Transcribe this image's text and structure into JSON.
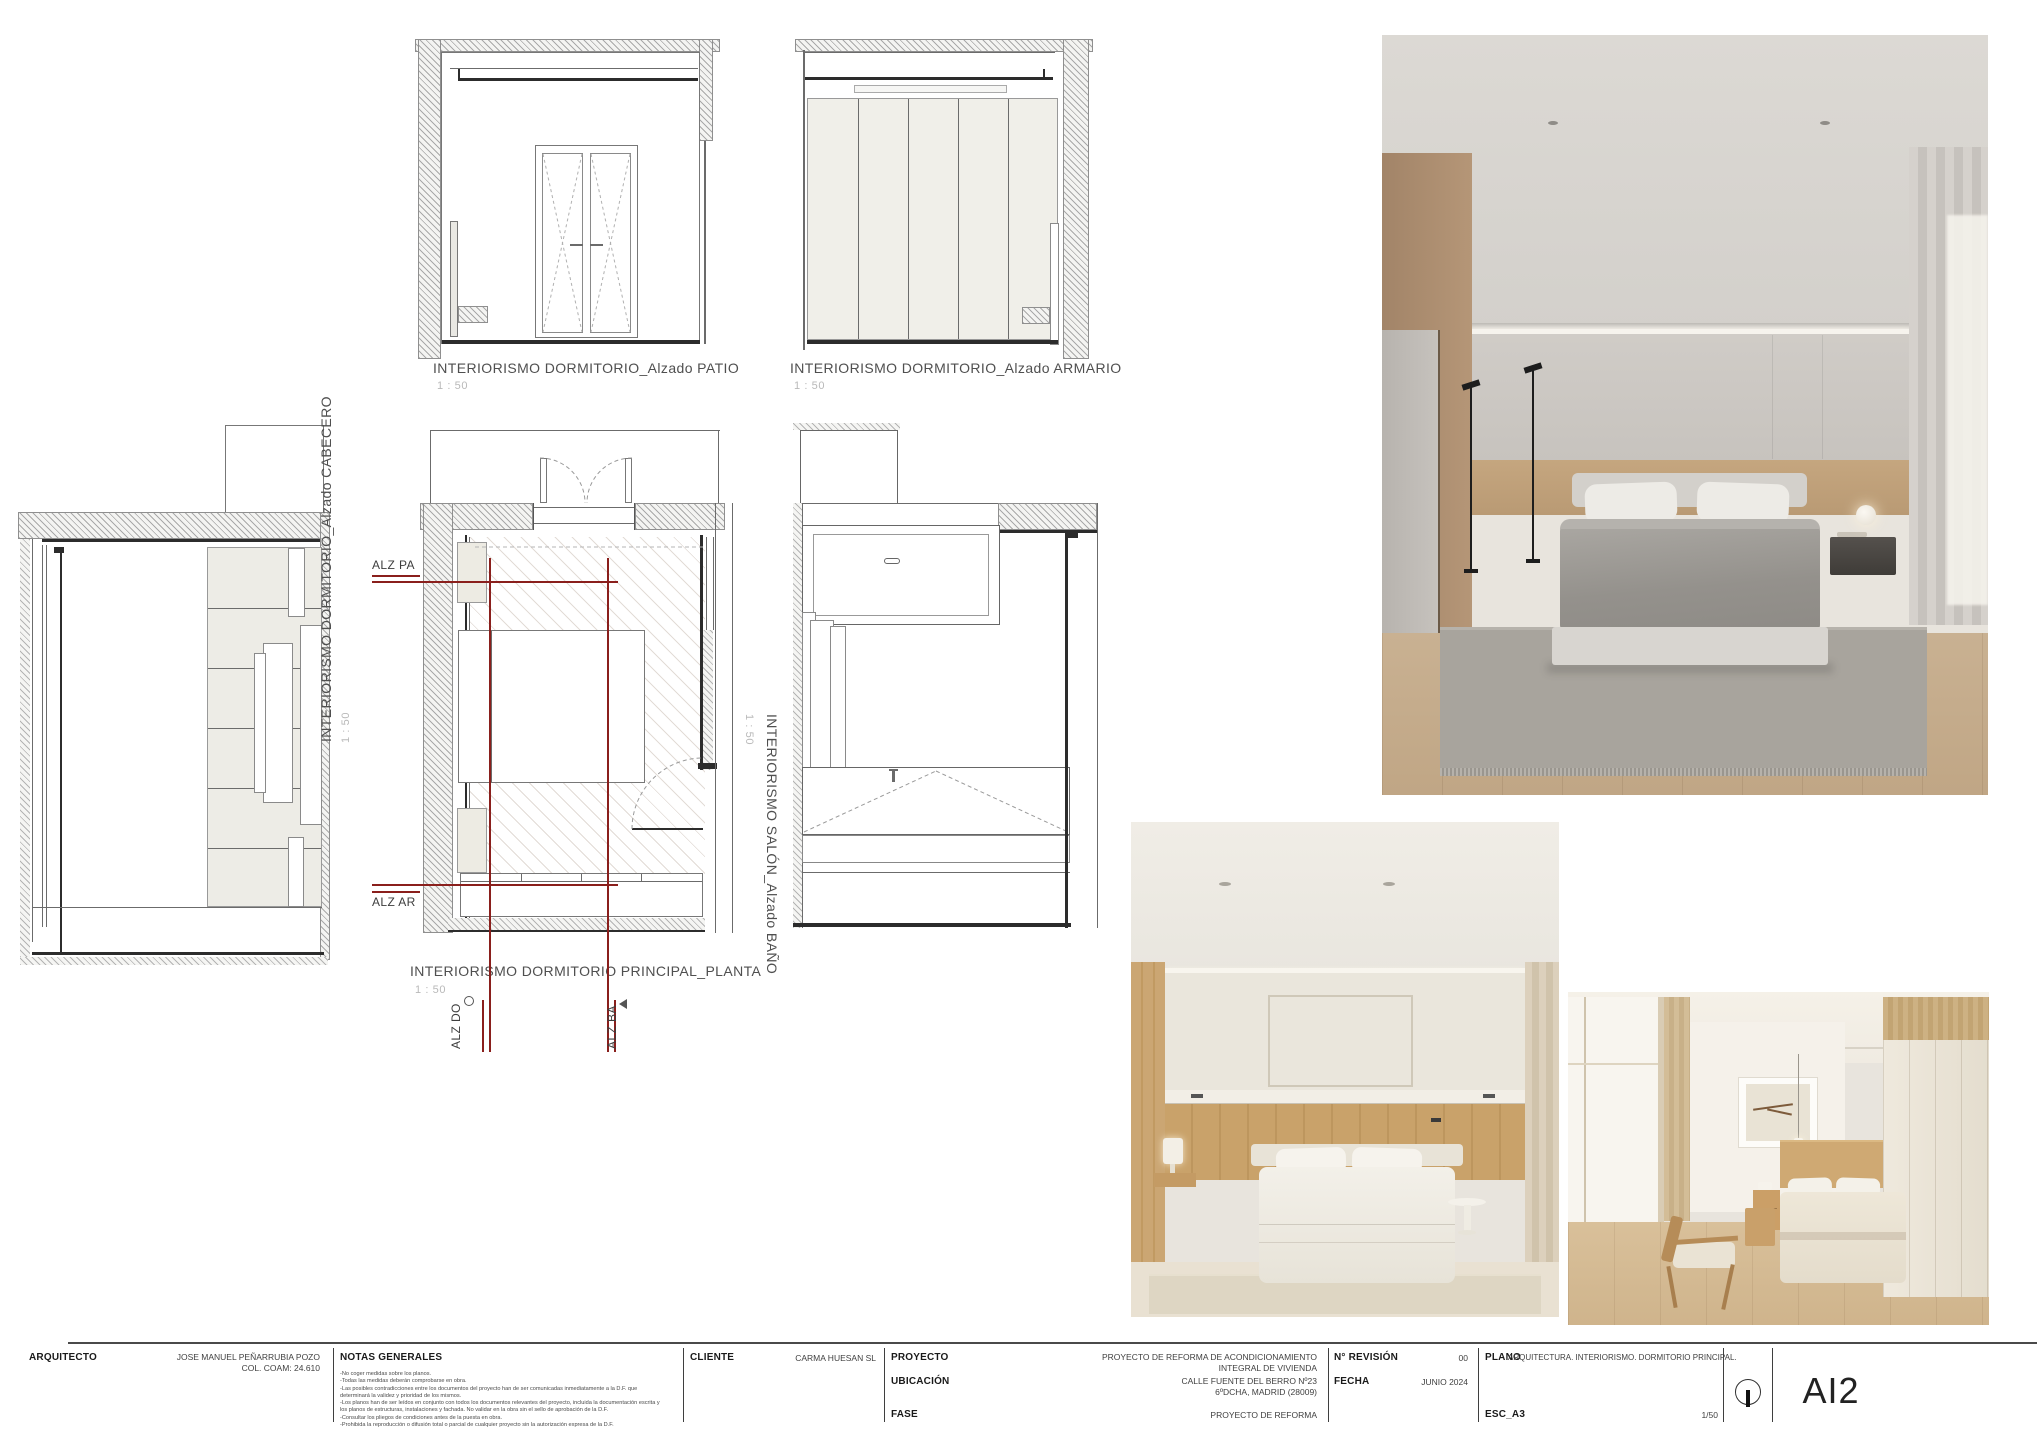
{
  "drawings": {
    "patio": {
      "title": "INTERIORISMO DORMITORIO_Alzado PATIO",
      "scale": "1 : 50"
    },
    "armario": {
      "title": "INTERIORISMO DORMITORIO_Alzado ARMARIO",
      "scale": "1 : 50"
    },
    "cabecero": {
      "title": "INTERIORISMO DORMITORIO_Alzado CABECERO",
      "scale": "1 : 50"
    },
    "planta": {
      "title": "INTERIORISMO DORMITORIO PRINCIPAL_PLANTA",
      "scale": "1 : 50"
    },
    "bano": {
      "title": "INTERIORISMO SALÓN_Alzado BAÑO",
      "scale": "1 : 50"
    }
  },
  "markers": {
    "alz_pa": "ALZ PA",
    "alz_ar": "ALZ AR",
    "alz_do": "ALZ DO",
    "alz_ba": "ALZ BA"
  },
  "titleblock": {
    "arquitecto_label": "ARQUITECTO",
    "arquitecto_value_1": "JOSE MANUEL PEÑARRUBIA POZO",
    "arquitecto_value_2": "COL. COAM: 24.610",
    "notas_label": "NOTAS GENERALES",
    "notas": [
      "-No coger medidas sobre los planos.",
      "-Todas las medidas deberán comprobarse en obra.",
      "-Las posibles contradicciones entre los documentos del proyecto han de ser comunicadas inmediatamente a la D.F. que determinará la validez y prioridad de los mismos.",
      "-Los planos han de ser leídos en conjunto con todos los documentos relevantes del proyecto, incluida la documentación escrita y los planos de estructuras, instalaciones y fachada. No validar en la obra sin el sello de aprobación de la D.F.",
      "-Consultar los pliegos de condiciones antes de la puesta en obra.",
      "-Prohibida la reproducción o difusión total o parcial de cualquier proyecto sin la autorización expresa de la D.F."
    ],
    "cliente_label": "CLIENTE",
    "cliente_value": "CARMA HUESAN SL",
    "proyecto_label": "PROYECTO",
    "proyecto_value": "PROYECTO DE REFORMA DE ACONDICIONAMIENTO INTEGRAL DE VIVIENDA",
    "ubicacion_label": "UBICACIÓN",
    "ubicacion_value": "CALLE FUENTE DEL BERRO Nº23 6ºDCHA, MADRID (28009)",
    "fase_label": "FASE",
    "fase_value": "PROYECTO DE REFORMA",
    "revision_label": "N° REVISIÓN",
    "revision_value": "00",
    "fecha_label": "FECHA",
    "fecha_value": "JUNIO 2024",
    "plano_label": "PLANO",
    "plano_value": "ARQUITECTURA. INTERIORISMO. DORMITORIO PRINCIPAL.",
    "esc_label": "ESC_A3",
    "esc_value": "1/50",
    "sheet_code": "AI2"
  },
  "colors": {
    "marker_red": "#8a1f1c",
    "panel_beige": "#edebe3",
    "wood": "#c49a66",
    "text_gray": "#4f4f4f"
  }
}
